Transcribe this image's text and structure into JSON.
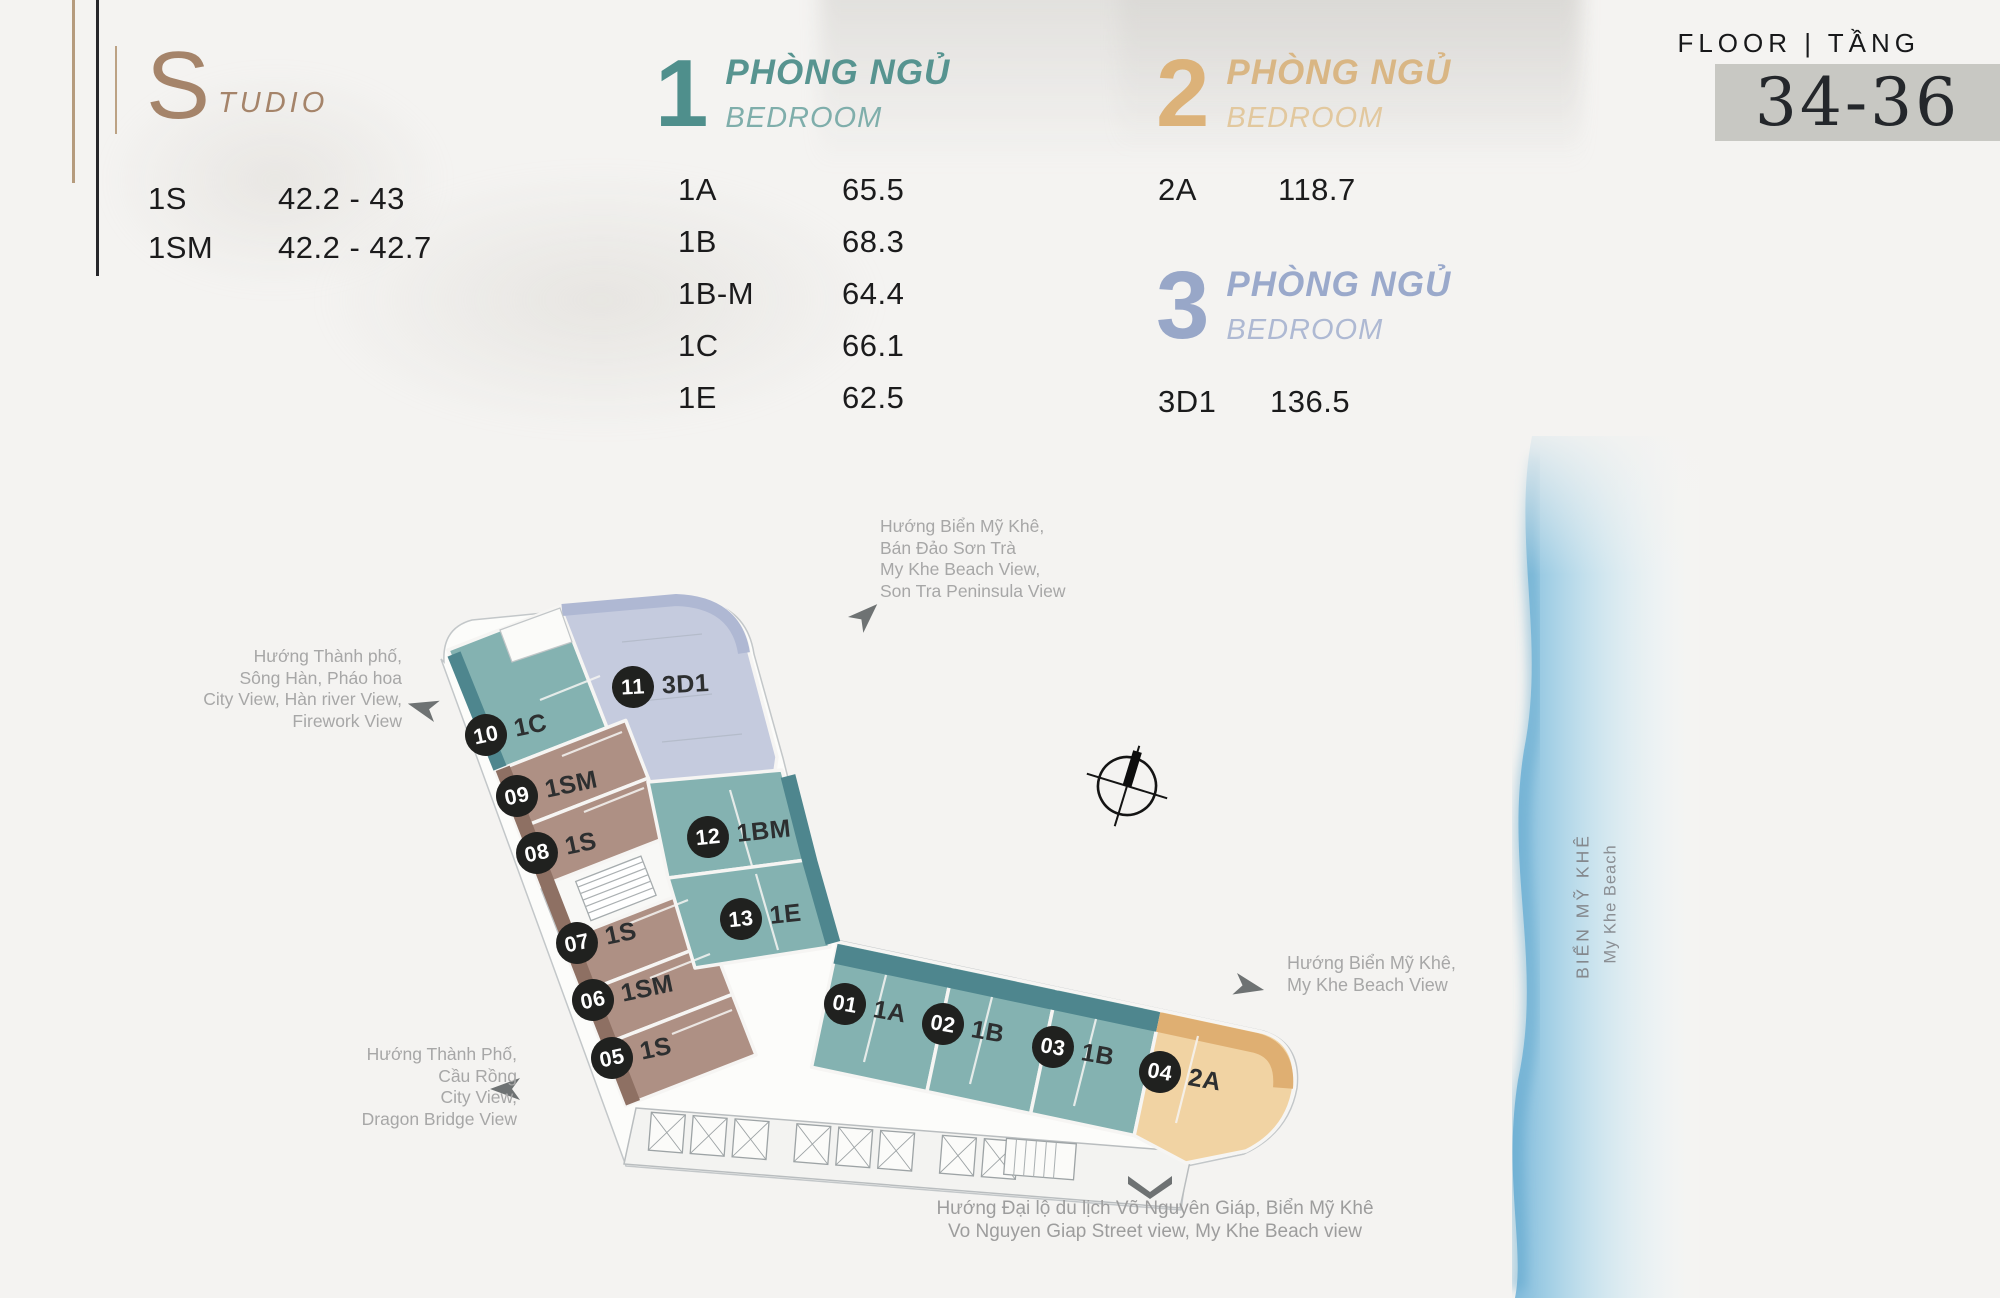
{
  "legend": {
    "studio": {
      "letter": "S",
      "word": "TUDIO",
      "rows": [
        {
          "code": "1S",
          "area": "42.2 - 43"
        },
        {
          "code": "1SM",
          "area": "42.2 - 42.7"
        }
      ]
    },
    "bed1": {
      "number": "1",
      "title_vn": "PHÒNG NGỦ",
      "title_en": "BEDROOM",
      "rows": [
        {
          "code": "1A",
          "area": "65.5"
        },
        {
          "code": "1B",
          "area": "68.3"
        },
        {
          "code": "1B-M",
          "area": "64.4"
        },
        {
          "code": "1C",
          "area": "66.1"
        },
        {
          "code": "1E",
          "area": "62.5"
        }
      ]
    },
    "bed2": {
      "number": "2",
      "title_vn": "PHÒNG NGỦ",
      "title_en": "BEDROOM",
      "rows": [
        {
          "code": "2A",
          "area": "118.7"
        }
      ]
    },
    "bed3": {
      "number": "3",
      "title_vn": "PHÒNG NGỦ",
      "title_en": "BEDROOM",
      "rows": [
        {
          "code": "3D1",
          "area": "136.5"
        }
      ]
    }
  },
  "floor": {
    "label": "FLOOR | TẦNG",
    "value": "34-36"
  },
  "annotations": {
    "top": {
      "lines": [
        "Hướng Biển Mỹ Khê,",
        "Bán Đảo Sơn Trà",
        "My Khe Beach View,",
        "Son Tra Peninsula View"
      ]
    },
    "left": {
      "lines": [
        "Hướng Thành phố,",
        "Sông Hàn, Pháo hoa",
        "City View, Hàn river View,",
        "Firework View"
      ]
    },
    "bottom_left": {
      "lines": [
        "Hướng Thành Phố,",
        "Cầu Rồng",
        "City View,",
        "Dragon Bridge View"
      ]
    },
    "right": {
      "lines": [
        "Hướng Biển Mỹ Khê,",
        "My Khe Beach View"
      ]
    },
    "bottom": {
      "lines": [
        "Hướng Đại lộ du lịch Võ Nguyên Giáp, Biển Mỹ Khê",
        "Vo Nguyen Giap Street view, My Khe Beach view"
      ]
    }
  },
  "beach": {
    "label_vn": "BIỂN MỸ KHÊ",
    "label_en": "My Khe Beach"
  },
  "plan": {
    "units": [
      {
        "no": "01",
        "type": "1A"
      },
      {
        "no": "02",
        "type": "1B"
      },
      {
        "no": "03",
        "type": "1B"
      },
      {
        "no": "04",
        "type": "2A"
      },
      {
        "no": "05",
        "type": "1S"
      },
      {
        "no": "06",
        "type": "1SM"
      },
      {
        "no": "07",
        "type": "1S"
      },
      {
        "no": "08",
        "type": "1S"
      },
      {
        "no": "09",
        "type": "1SM"
      },
      {
        "no": "10",
        "type": "1C"
      },
      {
        "no": "11",
        "type": "3D1"
      },
      {
        "no": "12",
        "type": "1BM"
      },
      {
        "no": "13",
        "type": "1E"
      }
    ]
  },
  "colors": {
    "studio_accent": "#A5846A",
    "bed1_accent": "#4F8F8C",
    "bed2_accent": "#DCB279",
    "bed3_accent": "#98A7C8",
    "unit_teal": "#84B2B1",
    "unit_teal_band": "#4E868E",
    "unit_brown": "#AE9084",
    "unit_brown_band": "#8E7063",
    "unit_lavender": "#C5CBDE",
    "unit_lavender_band": "#AFB8D3",
    "unit_tan": "#F1D3A3",
    "unit_tan_band": "#DFAF72",
    "marker_bg": "#20211F",
    "badge_bg": "#C8C8C3",
    "annotation_gray": "#A7A7A7",
    "sea_blue": "#6FB0D6"
  }
}
